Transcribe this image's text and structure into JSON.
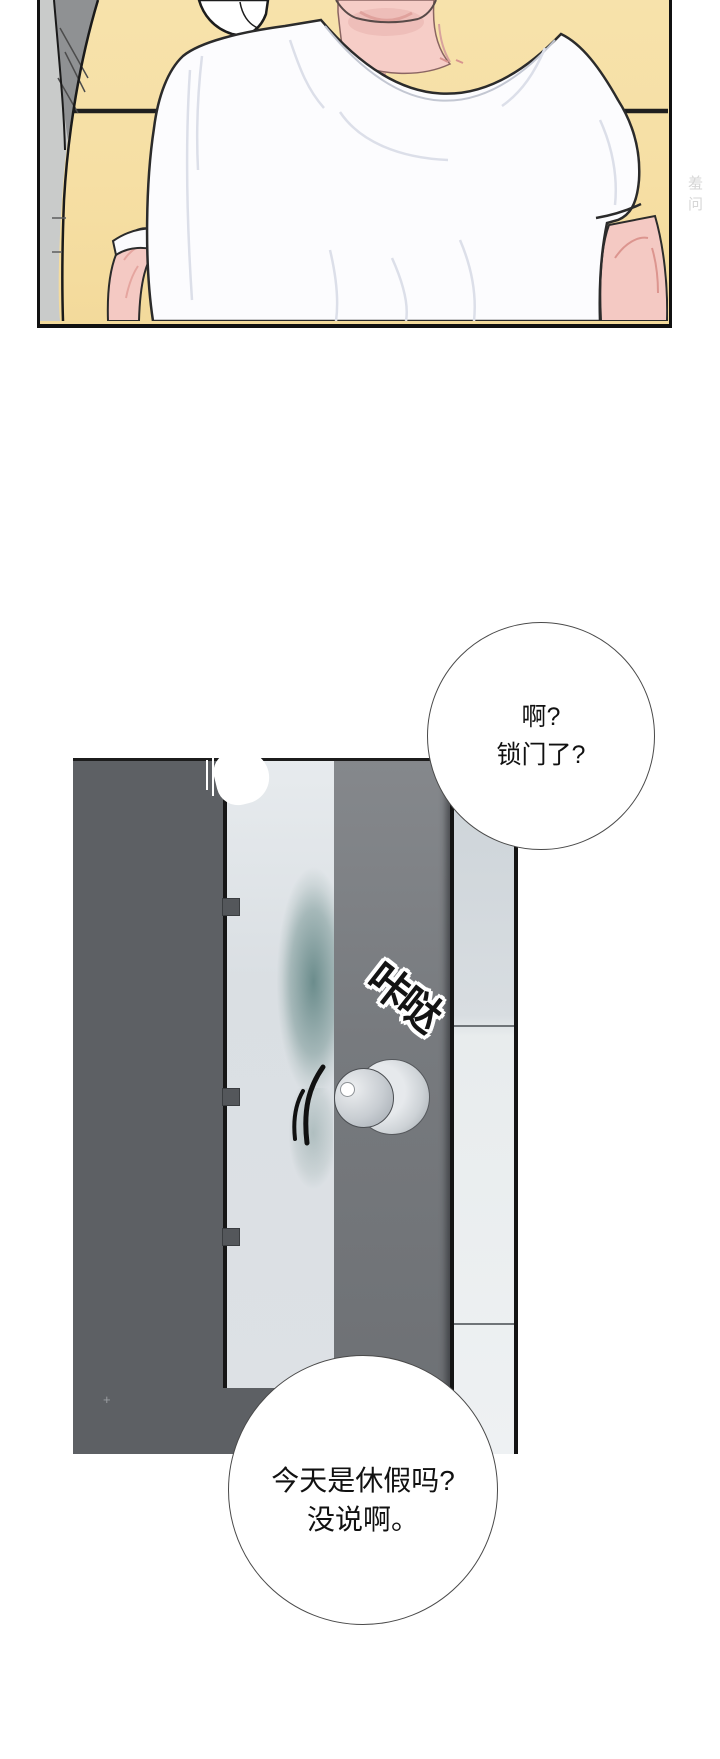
{
  "page": {
    "type": "webtoon-comic-page",
    "background": "#ffffff",
    "watermark": "羞问"
  },
  "panel1": {
    "description": "person in white t-shirt sitting against yellow couch",
    "colors": {
      "couch_yellow": "#f6dfa4",
      "seam_black": "#1f1f1f",
      "skin_pink": "#f4c9c3",
      "shirt_white": "#fcfcfe",
      "border_black": "#111111"
    }
  },
  "panel2": {
    "description": "closed door with doorknob rattling",
    "sfx": "咔哒",
    "floor_mark": "+",
    "colors": {
      "wall_dark_gray": "#5d6064",
      "door_light": "#dde1e5",
      "door_mid_gray": "#777a7e",
      "jamb_light": "#e8eced",
      "teal_shadow": "#587e7d",
      "knob_gray": "#c8cdd2"
    }
  },
  "bubbles": [
    {
      "lines": [
        "啊?",
        "锁门了?"
      ]
    },
    {
      "lines": [
        "今天是休假吗?",
        "没说啊。"
      ]
    }
  ]
}
